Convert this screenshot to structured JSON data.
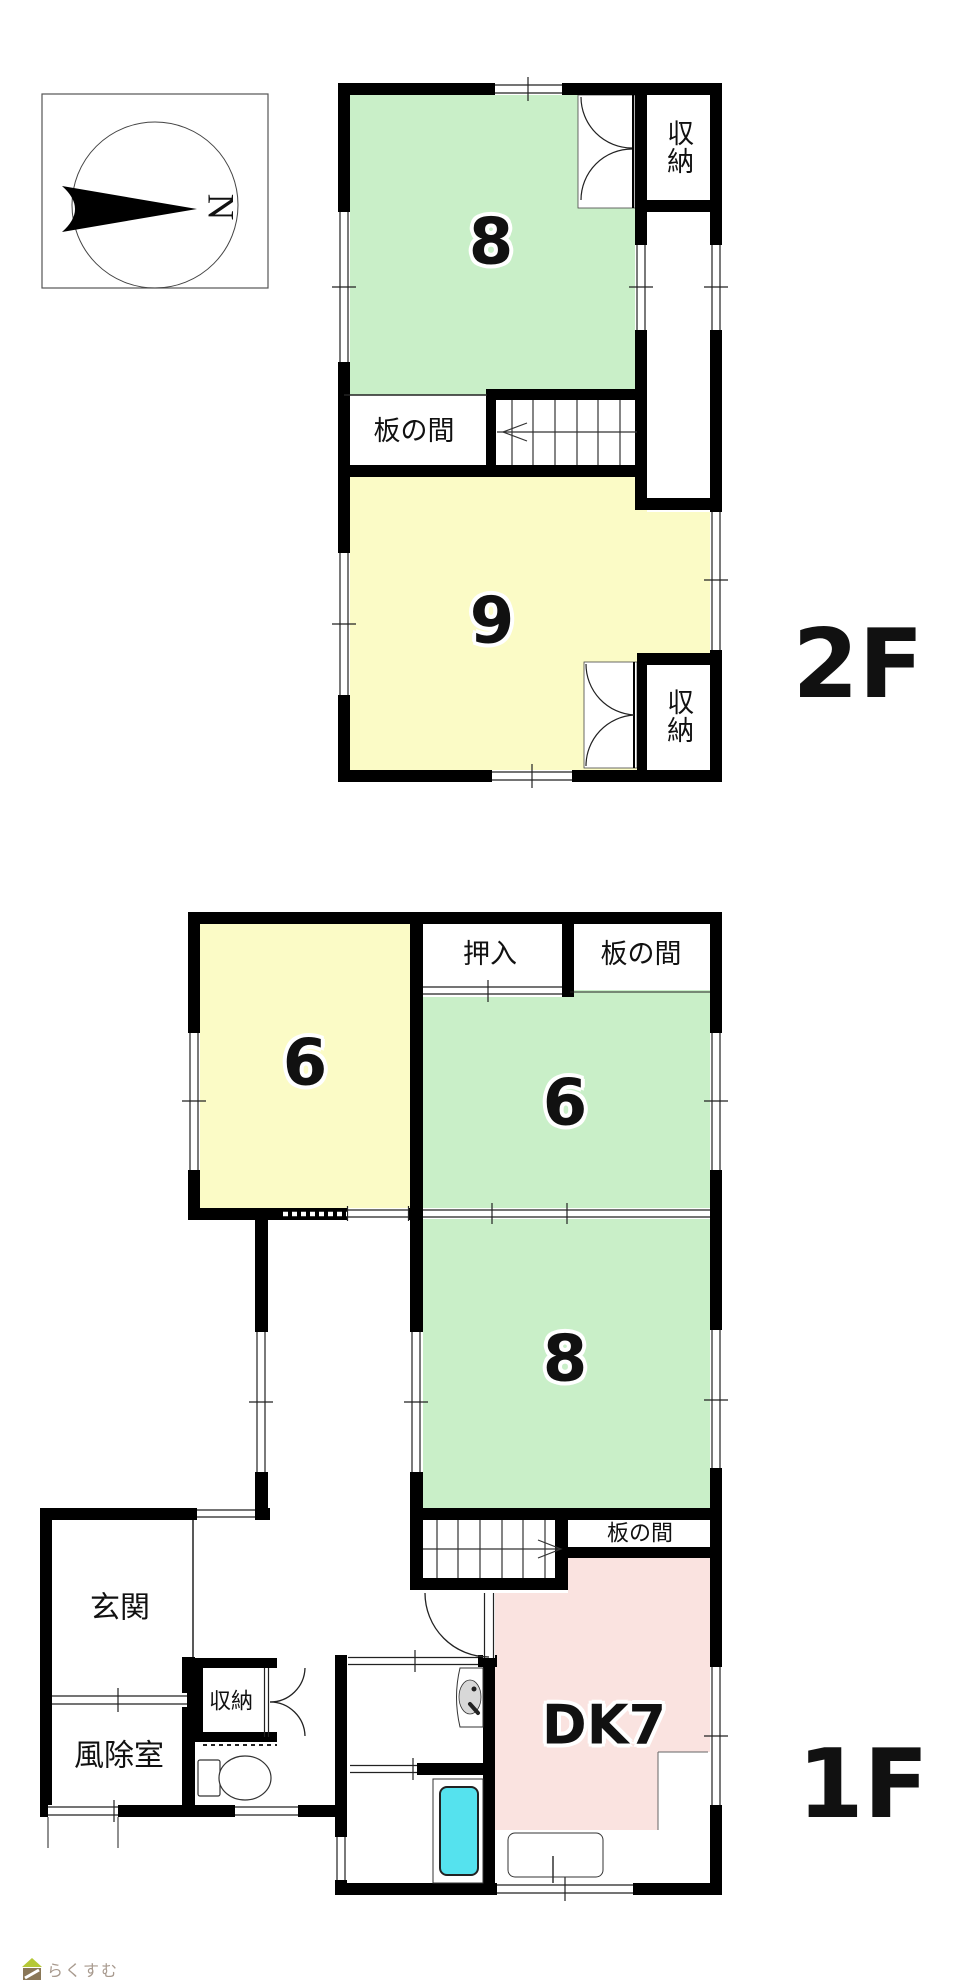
{
  "compass": {
    "north_label": "N"
  },
  "floor_2f": {
    "floor_label": "2F",
    "rooms": {
      "room8": "8",
      "room9": "9",
      "itanoma": "板の間",
      "closet_top": "収納",
      "closet_bottom": "収納"
    }
  },
  "floor_1f": {
    "floor_label": "1F",
    "rooms": {
      "room6_west": "6",
      "room6_east": "6",
      "room8": "8",
      "oshiire": "押入",
      "itanoma_north": "板の間",
      "itanoma_south": "板の間",
      "dk": "DK7",
      "genkan": "玄関",
      "fujoshitsu": "風除室",
      "closet": "収納"
    }
  },
  "watermark": {
    "text": "らくすむ"
  },
  "colors": {
    "tatami_green": "#c9efc8",
    "tatami_yellow": "#fbfbc6",
    "dk_pink": "#fae3e0",
    "bathtub_cyan": "#55e2ee",
    "fixture_gray": "#d8d8d8",
    "wall_black": "#000000",
    "watermark_text": "#a89a8e",
    "logo_green": "#b5c837",
    "logo_brown": "#8a7757"
  }
}
